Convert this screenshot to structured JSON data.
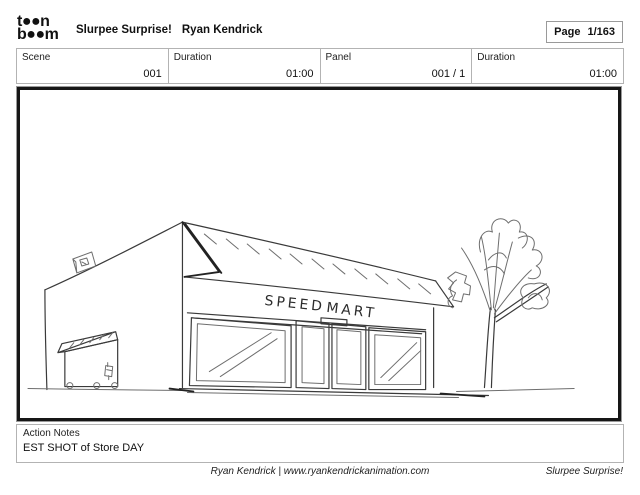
{
  "header": {
    "logo_line1": "t●●n",
    "logo_line2": "b●●m",
    "title_project": "Slurpee Surprise!",
    "title_author": "Ryan Kendrick",
    "page_label": "Page",
    "page_value": "1/163"
  },
  "info_row": {
    "cells": [
      {
        "label": "Scene",
        "value": "001"
      },
      {
        "label": "Duration",
        "value": "01:00"
      },
      {
        "label": "Panel",
        "value": "001 / 1"
      },
      {
        "label": "Duration",
        "value": "01:00"
      }
    ]
  },
  "panel_sketch": {
    "sign_word1": "SPEED",
    "sign_word2": "MART"
  },
  "notes": {
    "label": "Action Notes",
    "text": "EST SHOT of Store DAY"
  },
  "footer": {
    "center": "Ryan Kendrick | www.ryankendrickanimation.com",
    "right": "Slurpee Surprise!"
  },
  "colors": {
    "ink": "#3a3a3a",
    "frame_black": "#161616",
    "border_gray": "#b3b3b3"
  }
}
